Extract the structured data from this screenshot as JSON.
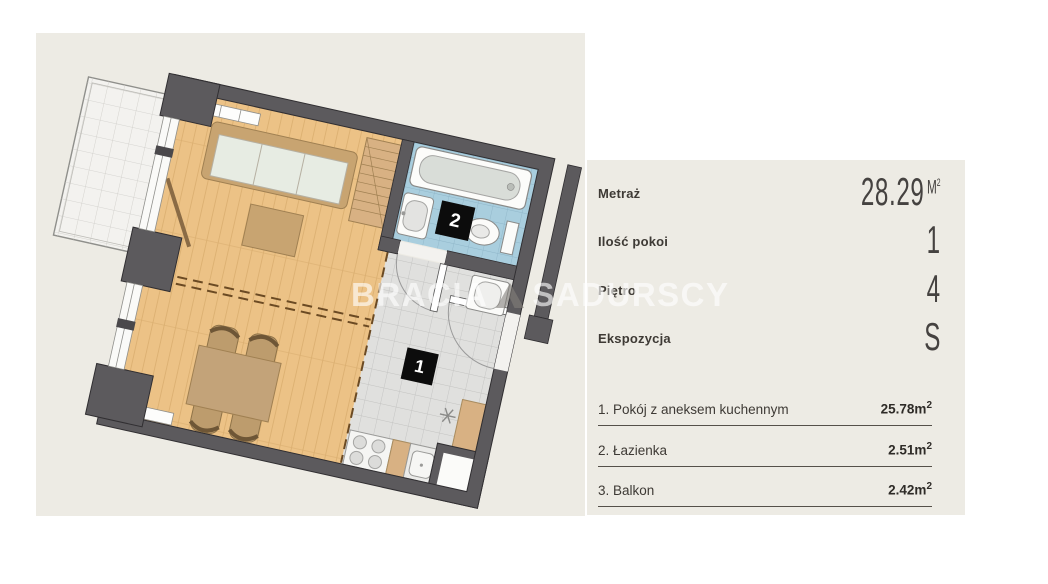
{
  "watermark": {
    "left": "BRACIA",
    "right": "SADURSCY"
  },
  "panel": {
    "metrics": [
      {
        "label": "Metraż",
        "value": "28.29",
        "unit": "M",
        "unit_sup": "2"
      },
      {
        "label": "Ilość pokoi",
        "value": "1",
        "unit": "",
        "unit_sup": ""
      },
      {
        "label": "Piętro",
        "value": "4",
        "unit": "",
        "unit_sup": ""
      },
      {
        "label": "Ekspozycja",
        "value": "S",
        "unit": "",
        "unit_sup": ""
      }
    ],
    "rooms": [
      {
        "name": "1. Pokój z aneksem kuchennym",
        "area": "25.78m",
        "area_sup": "2"
      },
      {
        "name": "2. Łazienka",
        "area": "2.51m",
        "area_sup": "2"
      },
      {
        "name": "3. Balkon",
        "area": "2.42m",
        "area_sup": "2"
      }
    ]
  },
  "plan": {
    "label_room_main": "1",
    "label_bathroom": "2"
  },
  "colors": {
    "background": "#ffffff",
    "plan_background": "#edebe4",
    "wall": "#5c5a5d",
    "wood_floor": "#ecc286",
    "bathroom_tile": "#a9cede",
    "hall_tile": "#e0e0de",
    "furniture_tan": "#c8a471",
    "label_black": "#0c0c0c"
  }
}
